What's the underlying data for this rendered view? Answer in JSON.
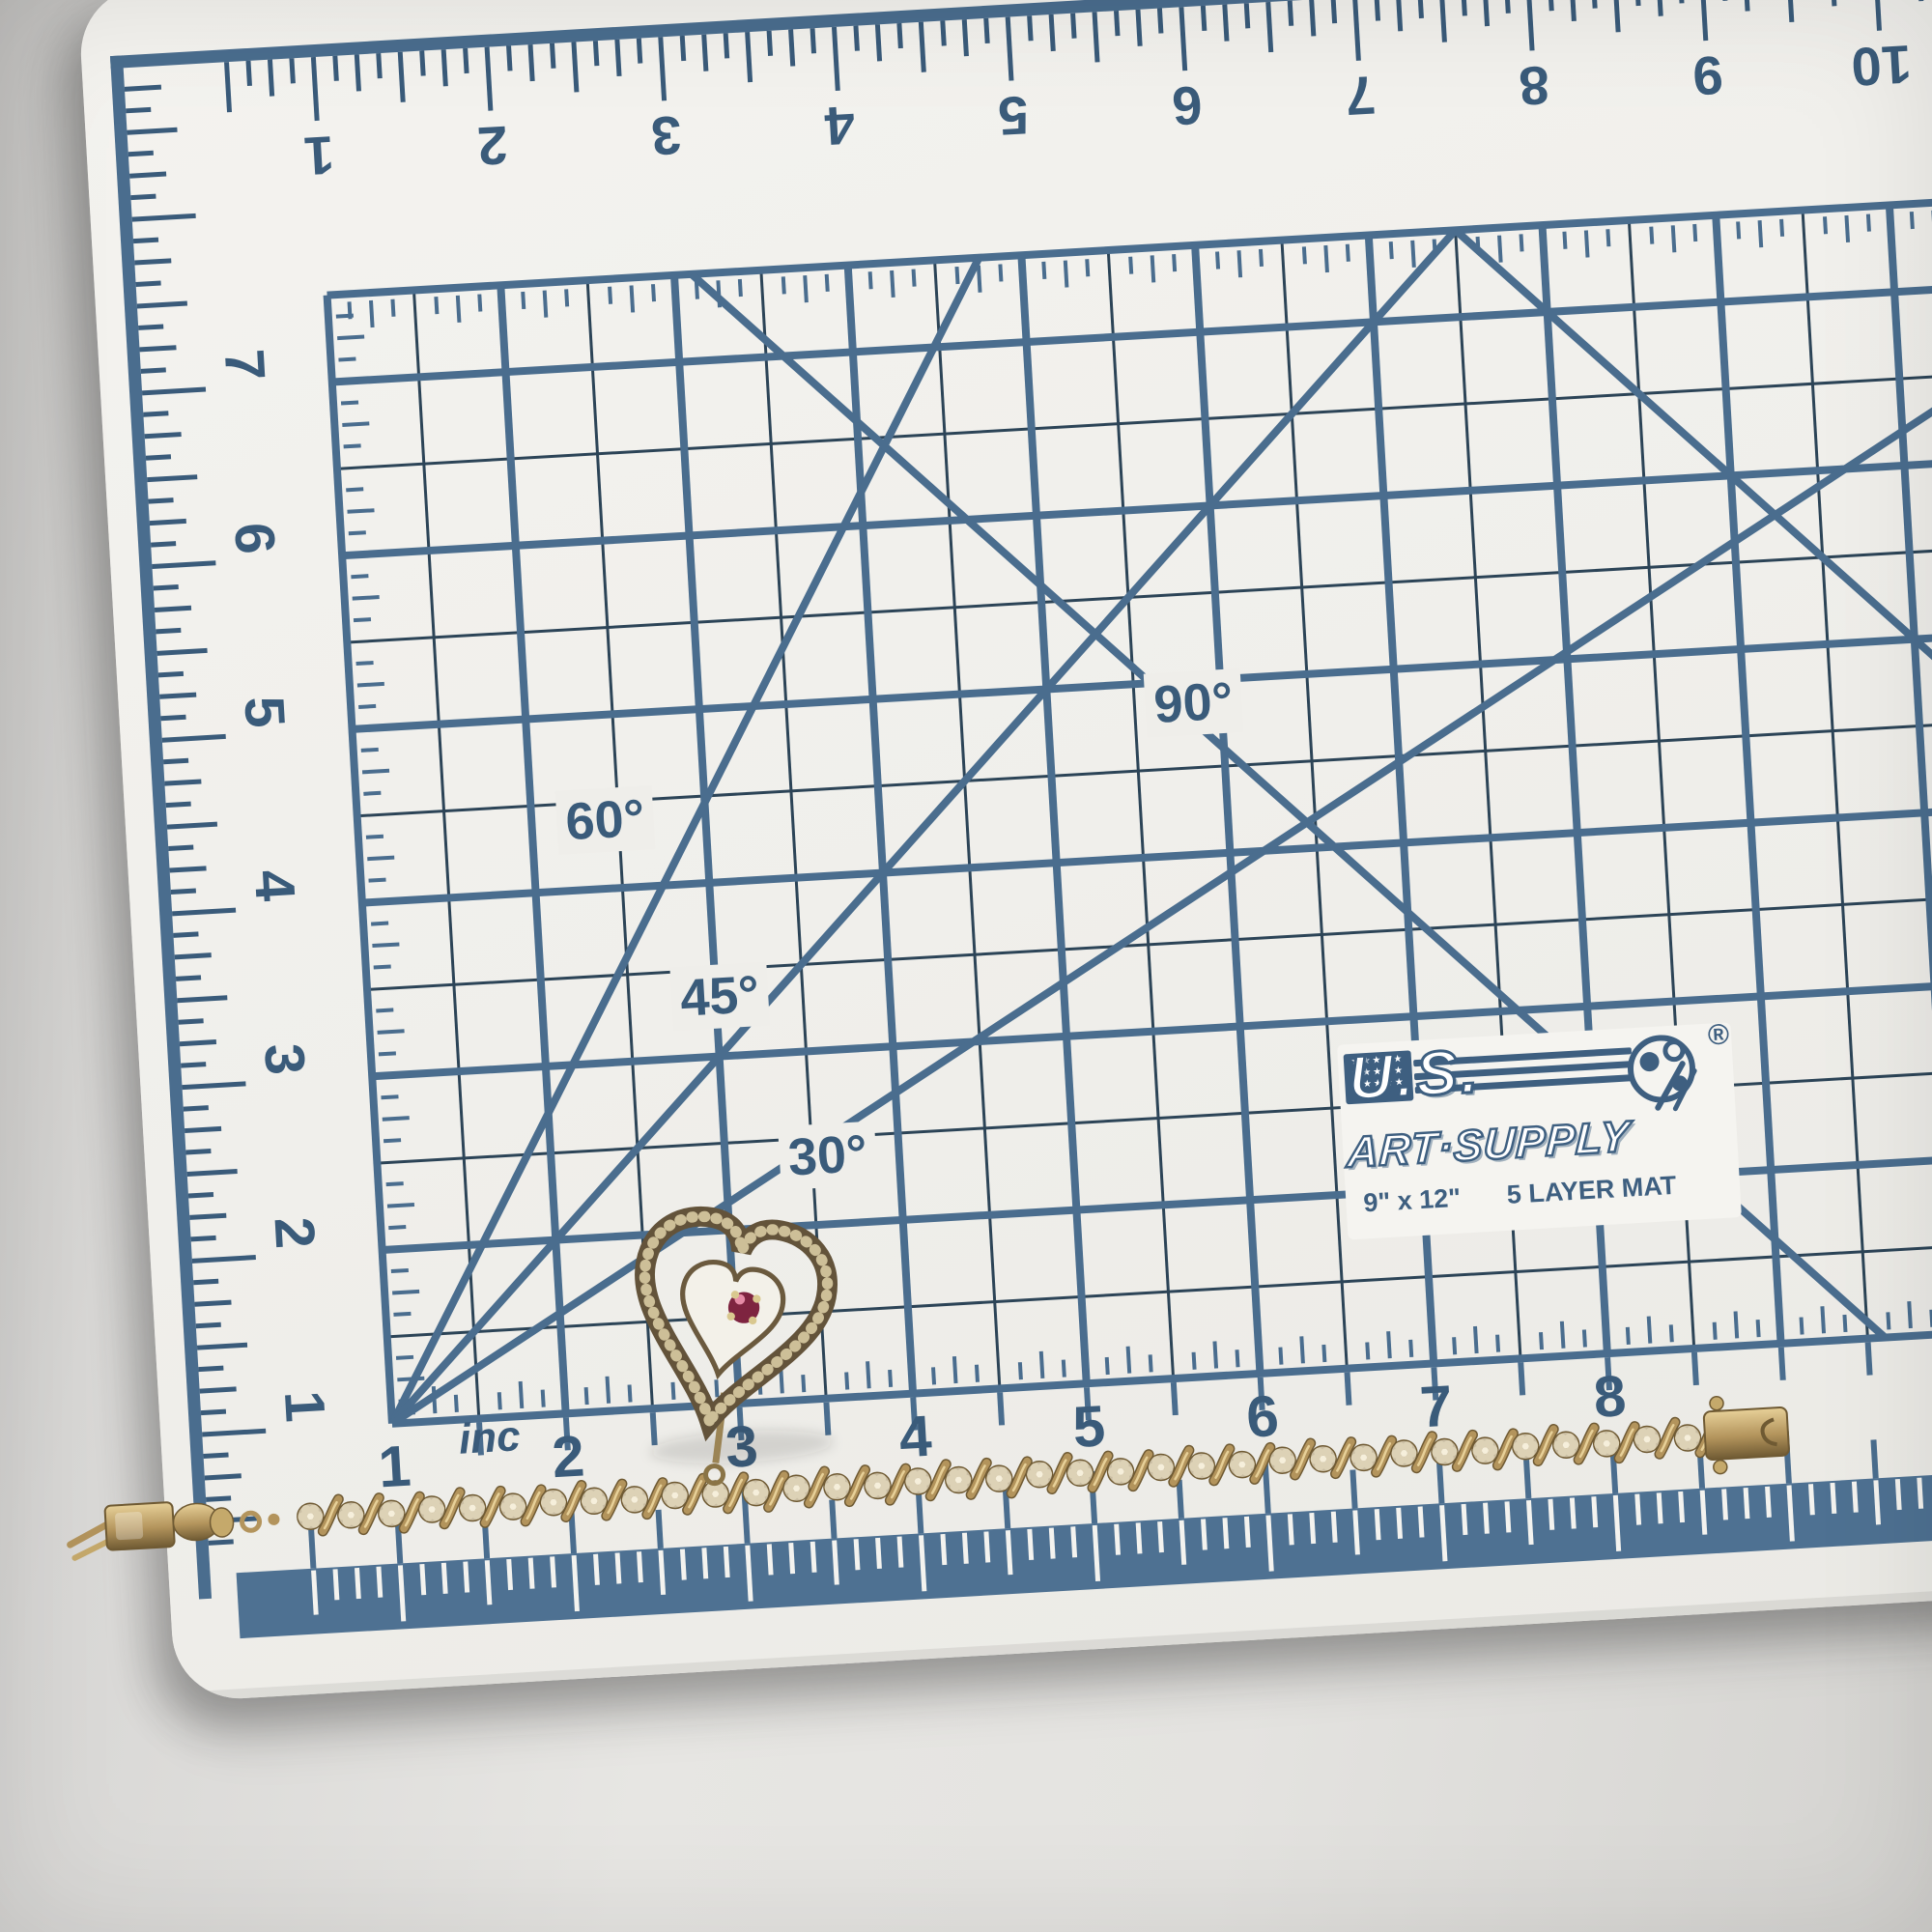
{
  "mat": {
    "brand": {
      "line1": "U.S.",
      "line2": "ART·SUPPLY",
      "registered": "®"
    },
    "size_label": "9\" x 12\"",
    "layer_label": "5 LAYER MAT",
    "unit_label": "inc",
    "angle_labels": [
      "90°",
      "60°",
      "45°",
      "30°"
    ],
    "top_numbers": [
      "1",
      "2",
      "3",
      "4",
      "5",
      "6",
      "7",
      "8",
      "9",
      "10"
    ],
    "left_numbers": [
      "7",
      "6",
      "5",
      "4",
      "3",
      "2",
      "1"
    ],
    "bottom_numbers": [
      "1",
      "2",
      "3",
      "4",
      "5",
      "6",
      "7",
      "8"
    ],
    "colors": {
      "surface": "#f1f0ec",
      "grid_major": "#4a6d8e",
      "grid_minor": "#2c4457",
      "numerals": "#3a5b7a",
      "edge_band": "#4e7192",
      "logo_blue": "#3e5f80",
      "tick_white": "#f4f3ef"
    },
    "icons": {
      "flag_stars": "★★★★★\n★★★★★\n★★★★★"
    }
  },
  "bracelet": {
    "description": "gold S-link bracelet with flower links and heart charm with red gem",
    "link_count": 35,
    "colors": {
      "gold": "#b3945c",
      "gold_dark": "#6f5a33",
      "gold_light": "#e7d098",
      "gold_mid": "#c5a96b",
      "flower": "#c9bda3",
      "flower_petal": "#ddd2b6",
      "flower_center": "#f6efdb",
      "gem": "#7e2440",
      "gem_highlight": "#e58ba6",
      "heart_bead": "#cdbf98",
      "heart_dark": "#63533a"
    }
  }
}
